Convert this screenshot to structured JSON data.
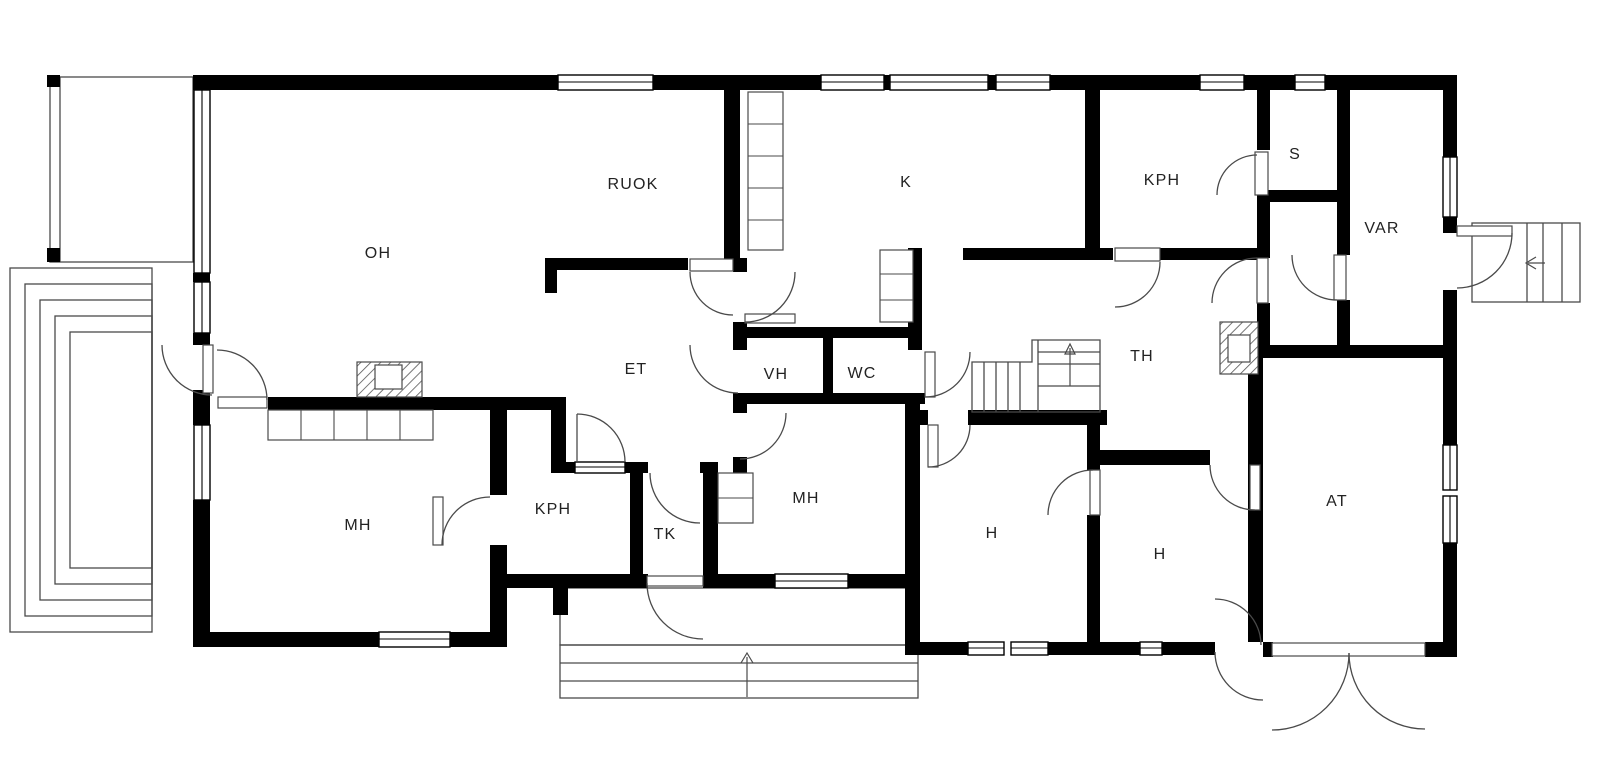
{
  "plan": {
    "type": "floor-plan",
    "rooms": {
      "oh": {
        "label": "OH"
      },
      "ruok": {
        "label": "RUOK"
      },
      "k": {
        "label": "K"
      },
      "kph_top": {
        "label": "KPH"
      },
      "s": {
        "label": "S"
      },
      "var": {
        "label": "VAR"
      },
      "et": {
        "label": "ET"
      },
      "vh": {
        "label": "VH"
      },
      "wc": {
        "label": "WC"
      },
      "th": {
        "label": "TH"
      },
      "mh_left": {
        "label": "MH"
      },
      "kph_low": {
        "label": "KPH"
      },
      "tk": {
        "label": "TK"
      },
      "mh_mid": {
        "label": "MH"
      },
      "h_left": {
        "label": "H"
      },
      "h_right": {
        "label": "H"
      },
      "at": {
        "label": "AT"
      }
    }
  },
  "colors": {
    "wall": "#000000",
    "line": "#4a4a4a",
    "background": "#ffffff",
    "text": "#222222"
  }
}
